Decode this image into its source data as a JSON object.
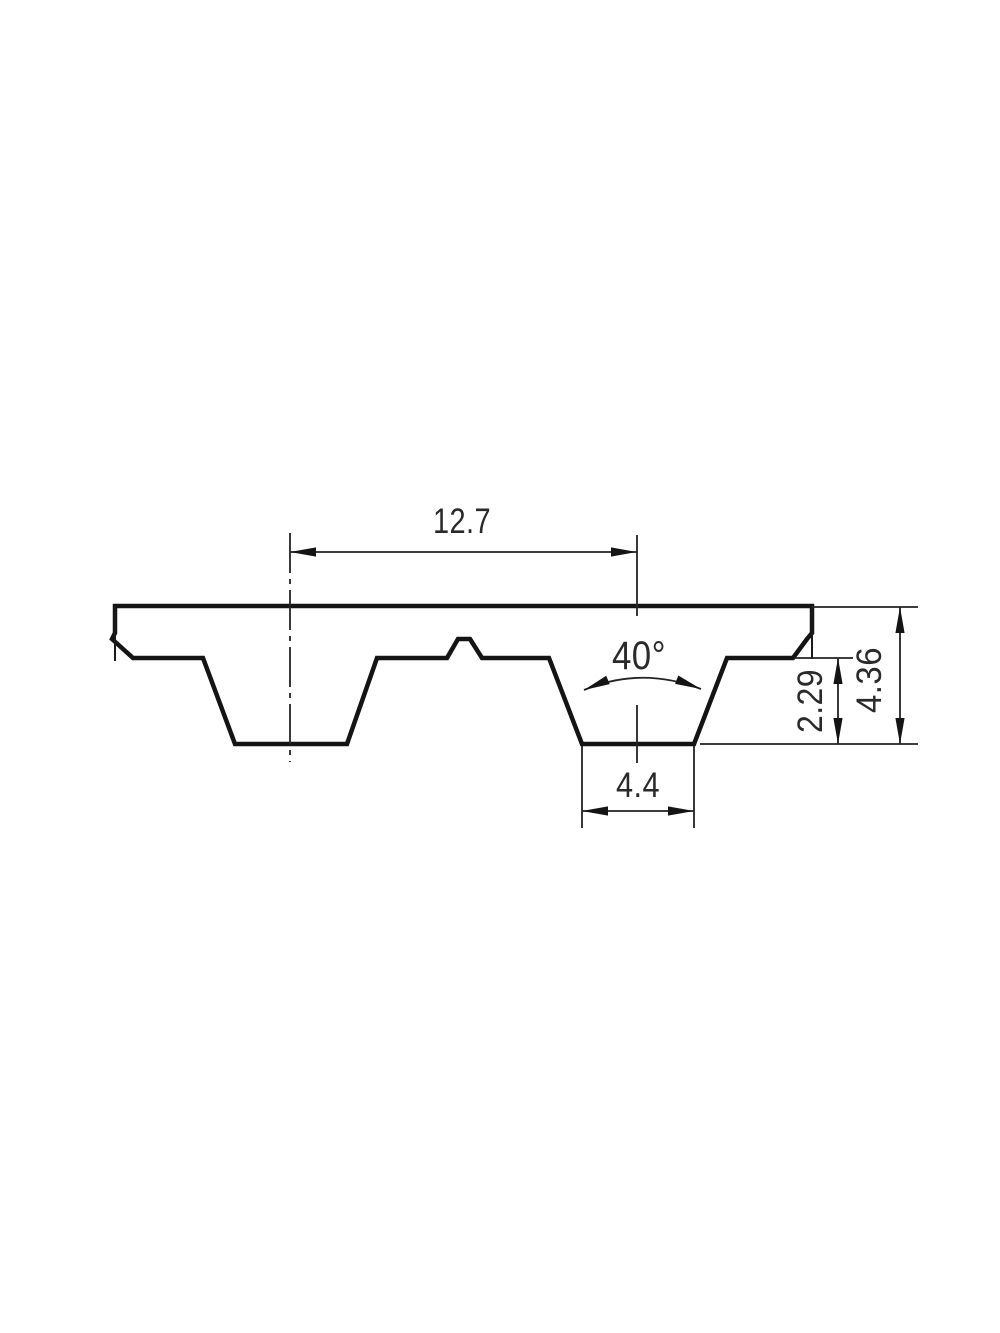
{
  "page": {
    "background": "#ffffff"
  },
  "drawing": {
    "kind": "belt tooth profile section",
    "profile_fill": "#ececec",
    "line_color": "#141414",
    "text_color": "#2a2a2a",
    "dimensions": {
      "pitch": "12.7",
      "angle": "40°",
      "tooth_height": "2.29",
      "belt_thickness": "4.36",
      "tooth_width": "4.4"
    }
  }
}
